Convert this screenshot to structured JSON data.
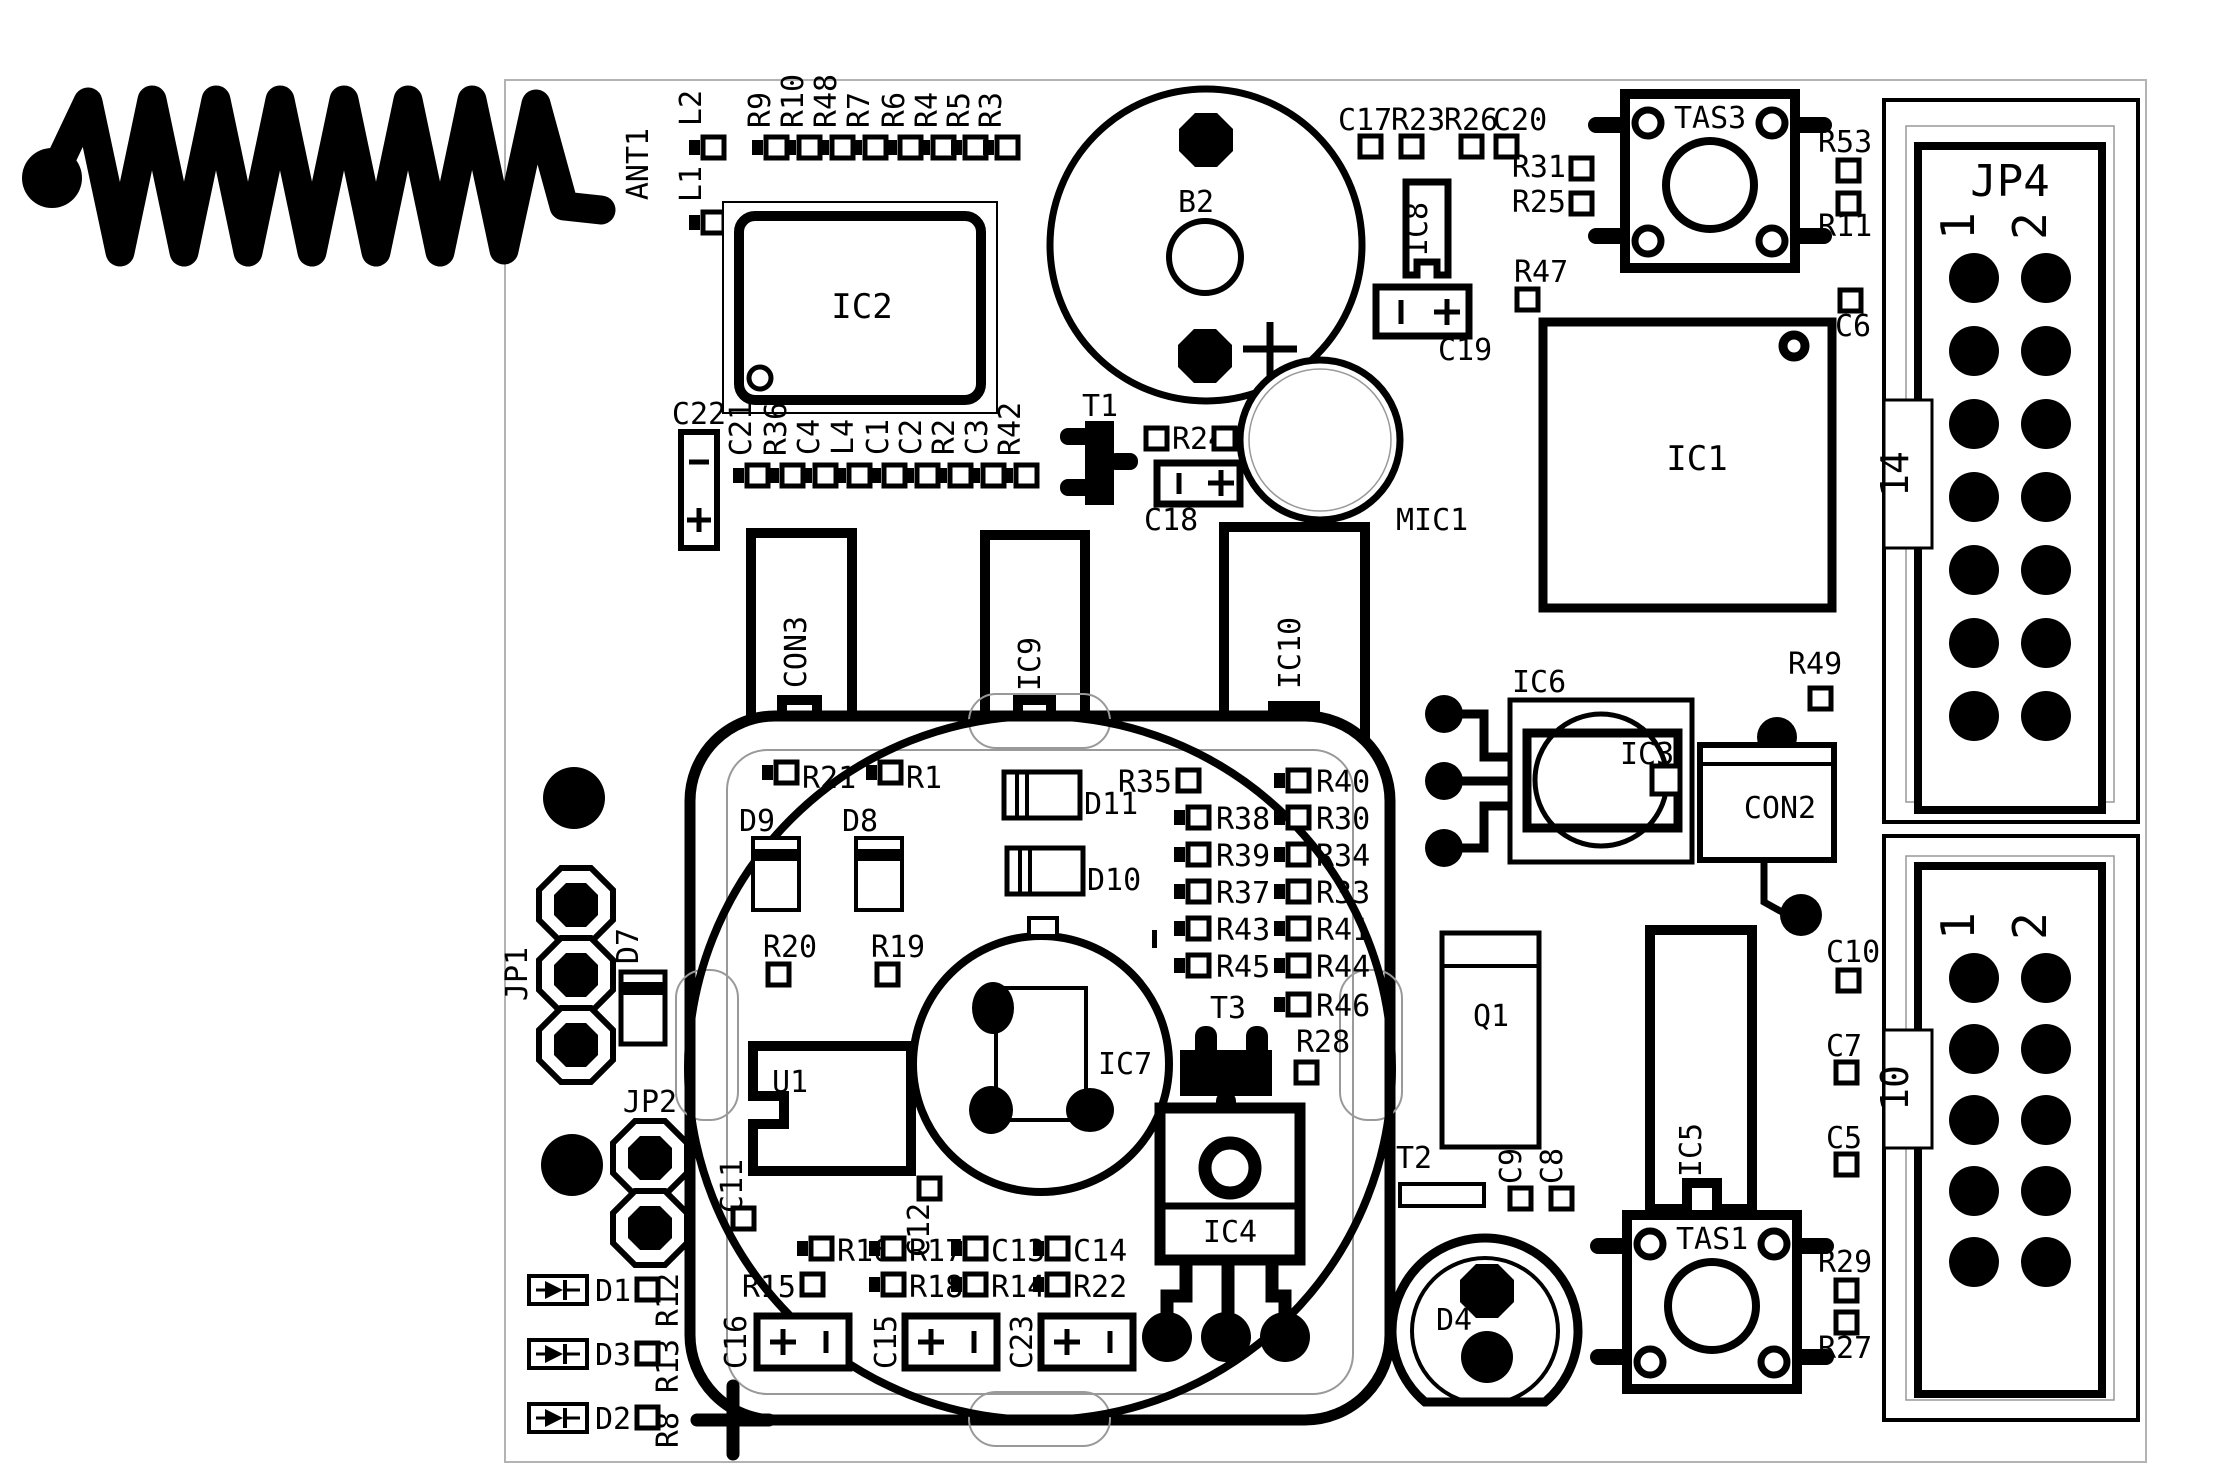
{
  "connector_top": {
    "name": "JP4",
    "col1": "1",
    "col2": "2",
    "pin_count": "14"
  },
  "connector_bottom": {
    "col1": "1",
    "col2": "2",
    "pin_count": "10"
  },
  "refs": {
    "ant1": "ANT1",
    "l1": "L1",
    "l2": "L2",
    "l4": "L4",
    "r1": "R1",
    "r2": "R2",
    "r3": "R3",
    "r4": "R4",
    "r5": "R5",
    "r6": "R6",
    "r7": "R7",
    "r8": "R8",
    "r9": "R9",
    "r10": "R10",
    "r11": "R11",
    "r12": "R12",
    "r13": "R13",
    "r14": "R14",
    "r15": "R15",
    "r16": "R16",
    "r17": "R17",
    "r18": "R18",
    "r19": "R19",
    "r20": "R20",
    "r21": "R21",
    "r22": "R22",
    "r23": "R23",
    "r24": "R24",
    "r25": "R25",
    "r26": "R26",
    "r27": "R27",
    "r28": "R28",
    "r29": "R29",
    "r30": "R30",
    "r31": "R31",
    "r32": "R32",
    "r33": "R33",
    "r34": "R34",
    "r35": "R35",
    "r36": "R36",
    "r37": "R37",
    "r38": "R38",
    "r39": "R39",
    "r40": "R40",
    "r41": "R41",
    "r42": "R42",
    "r43": "R43",
    "r44": "R44",
    "r45": "R45",
    "r46": "R46",
    "r47": "R47",
    "r48": "R48",
    "r49": "R49",
    "r53": "R53",
    "c1": "C1",
    "c2": "C2",
    "c3": "C3",
    "c4": "C4",
    "c5": "C5",
    "c6": "C6",
    "c7": "C7",
    "c8": "C8",
    "c9": "C9",
    "c10": "C10",
    "c11": "C11",
    "c12": "C12",
    "c13": "C13",
    "c14": "C14",
    "c15": "C15",
    "c16": "C16",
    "c17": "C17",
    "c18": "C18",
    "c19": "C19",
    "c20": "C20",
    "c21": "C21",
    "c22": "C22",
    "c23": "C23",
    "d1": "D1",
    "d2": "D2",
    "d3": "D3",
    "d4": "D4",
    "d7": "D7",
    "d8": "D8",
    "d9": "D9",
    "d10": "D10",
    "d11": "D11",
    "ic1": "IC1",
    "ic2": "IC2",
    "ic3": "IC3",
    "ic4": "IC4",
    "ic5": "IC5",
    "ic6": "IC6",
    "ic7": "IC7",
    "ic8": "IC8",
    "ic9": "IC9",
    "ic10": "IC10",
    "con2": "CON2",
    "con3": "CON3",
    "jp1": "JP1",
    "jp2": "JP2",
    "tas1": "TAS1",
    "tas3": "TAS3",
    "t1": "T1",
    "t2": "T2",
    "t3": "T3",
    "u1": "U1",
    "q1": "Q1",
    "b2": "B2",
    "mic1": "MIC1"
  }
}
